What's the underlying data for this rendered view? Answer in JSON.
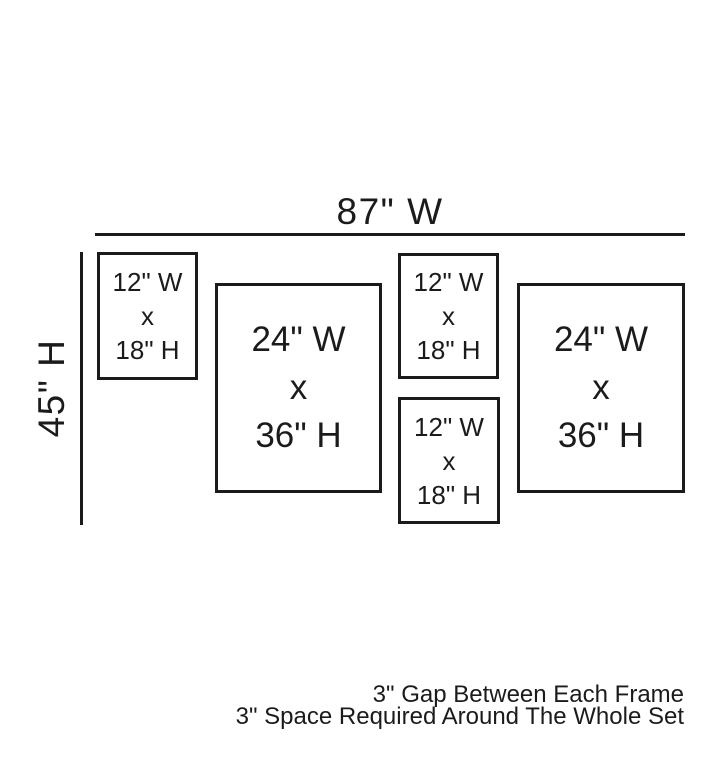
{
  "diagram": {
    "total_width_label": "87\" W",
    "total_height_label": "45\" H",
    "frames": [
      {
        "name": "small-frame-top-left",
        "lines": [
          "12\" W",
          "x",
          "18\" H"
        ]
      },
      {
        "name": "large-frame-left",
        "lines": [
          "24\" W",
          "x",
          "36\" H"
        ]
      },
      {
        "name": "small-frame-middle-top",
        "lines": [
          "12\" W",
          "x",
          "18\" H"
        ]
      },
      {
        "name": "small-frame-middle-bottom",
        "lines": [
          "12\" W",
          "x",
          "18\" H"
        ]
      },
      {
        "name": "large-frame-right",
        "lines": [
          "24\" W",
          "x",
          "36\" H"
        ]
      }
    ],
    "notes": {
      "line1": "3\" Gap Between Each Frame",
      "line2": "3\" Space Required Around The Whole Set"
    },
    "colors": {
      "ink": "#1b1b1b",
      "background": "#ffffff"
    }
  }
}
